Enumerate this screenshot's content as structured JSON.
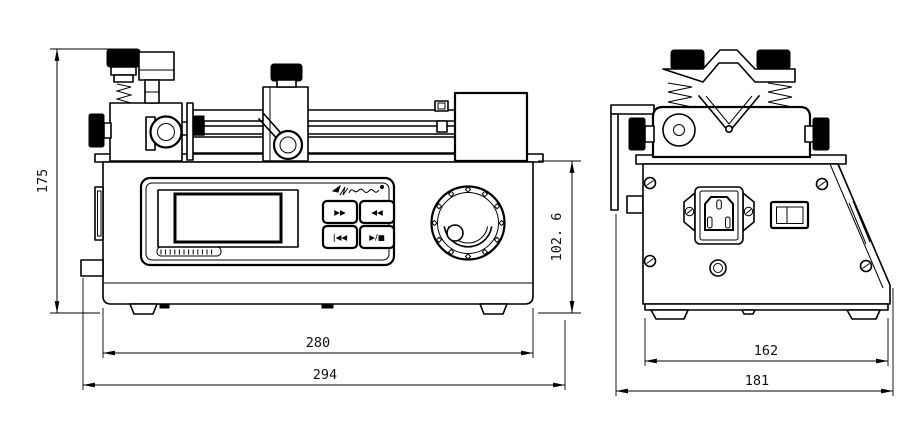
{
  "meta": {
    "drawing_type": "syringe-pump dimensional engineering drawing, front and side orthographic views",
    "colors": {
      "line": "#000000",
      "background": "#ffffff",
      "knob_fill": "#000000"
    }
  },
  "front_view": {
    "name": "front view",
    "panel": {
      "logo_icon": "script-brand-logo",
      "display": "lcd-screen",
      "serial_label_icon": "striped-text-label",
      "dial_icon": "jog-dial-with-tick-marks"
    },
    "panel_buttons": [
      {
        "name": "fast-forward",
        "glyph": "▶▶"
      },
      {
        "name": "fast-reverse",
        "glyph": "◀◀"
      },
      {
        "name": "back-to-start",
        "glyph": "|◀◀"
      },
      {
        "name": "start-stop",
        "glyph": "▶/■"
      }
    ],
    "dimensions": [
      {
        "name": "overall-height",
        "value": "175"
      },
      {
        "name": "body-height",
        "value": "102. 6"
      },
      {
        "name": "body-width",
        "value": "280"
      },
      {
        "name": "overall-width",
        "value": "294"
      }
    ]
  },
  "side_view": {
    "name": "side view",
    "features": [
      "v-clamp-head",
      "iec-power-inlet",
      "rocker-switch",
      "round-connector",
      "panel-screws"
    ],
    "dimensions": [
      {
        "name": "body-depth",
        "value": "162"
      },
      {
        "name": "overall-depth",
        "value": "181"
      }
    ]
  }
}
